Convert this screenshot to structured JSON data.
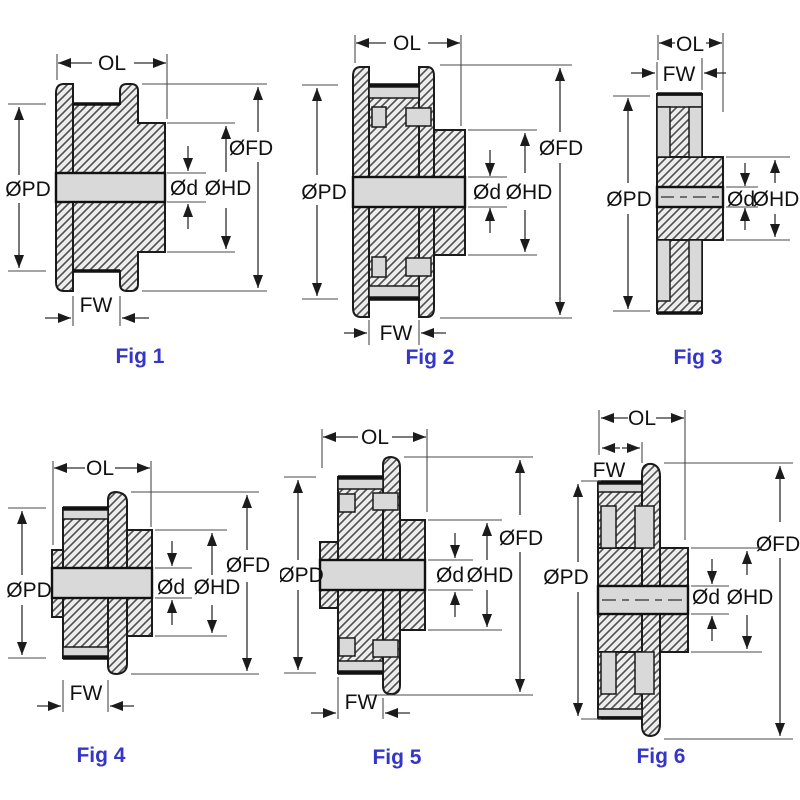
{
  "colors": {
    "caption_blue": "#3535c8",
    "outline": "#1b1b1b",
    "hatch_fill": "#ededed",
    "recess_gray": "#d9d9d9",
    "background": "#ffffff"
  },
  "figures": [
    {
      "caption": "Fig 1",
      "labels": {
        "ol": "OL",
        "fw": "FW",
        "pd": "ØPD",
        "fd": "ØFD",
        "hd": "ØHD",
        "d": "Ød"
      }
    },
    {
      "caption": "Fig 2",
      "labels": {
        "ol": "OL",
        "fw": "FW",
        "pd": "ØPD",
        "fd": "ØFD",
        "hd": "ØHD",
        "d": "Ød"
      }
    },
    {
      "caption": "Fig 3",
      "labels": {
        "ol": "OL",
        "fw": "FW",
        "pd": "ØPD",
        "hd": "ØHD",
        "d": "Ød"
      }
    },
    {
      "caption": "Fig 4",
      "labels": {
        "ol": "OL",
        "fw": "FW",
        "pd": "ØPD",
        "fd": "ØFD",
        "hd": "ØHD",
        "d": "Ød"
      }
    },
    {
      "caption": "Fig 5",
      "labels": {
        "ol": "OL",
        "fw": "FW",
        "pd": "ØPD",
        "fd": "ØFD",
        "hd": "ØHD",
        "d": "Ød"
      }
    },
    {
      "caption": "Fig 6",
      "labels": {
        "ol": "OL",
        "fw": "FW",
        "pd": "ØPD",
        "fd": "ØFD",
        "hd": "ØHD",
        "d": "Ød"
      }
    }
  ]
}
